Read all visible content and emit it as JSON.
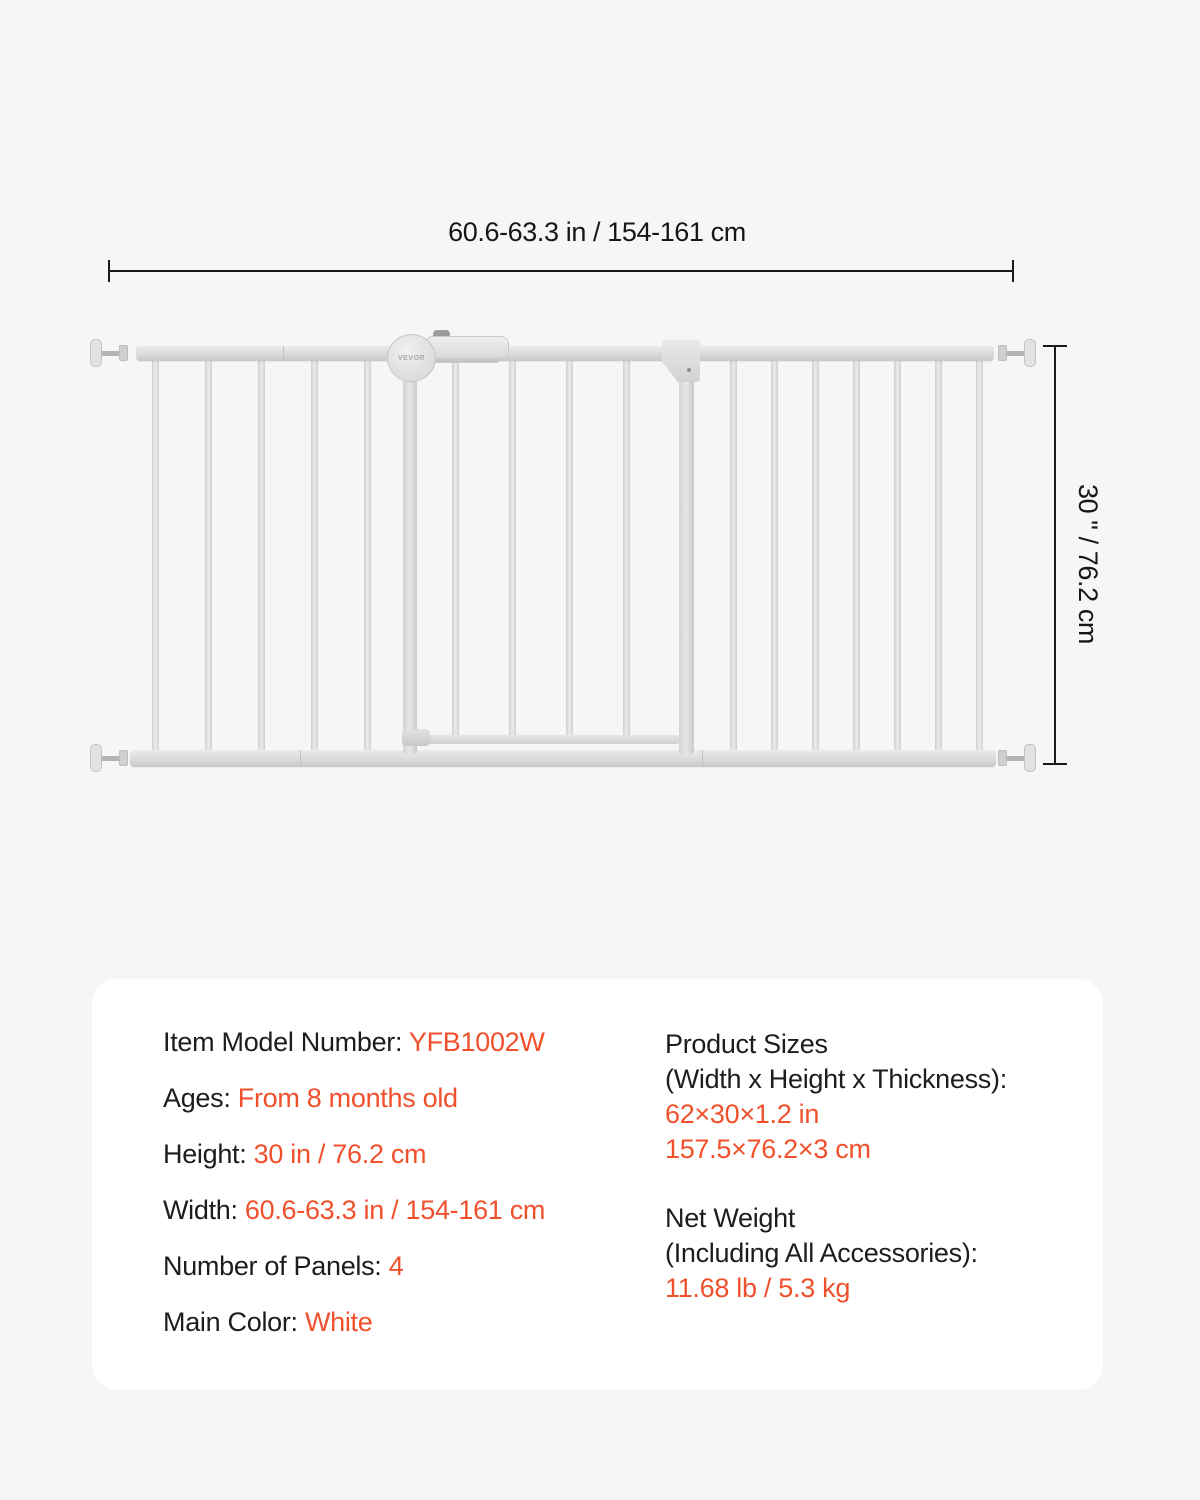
{
  "page": {
    "background_color": "#f6f6f5",
    "card_color": "#ffffff",
    "accent_color": "#f0512c"
  },
  "diagram": {
    "width_label": "60.6-63.3 in / 154-161 cm",
    "height_label": "30 \" / 76.2 cm",
    "brand_logo": "VEVOR"
  },
  "spec_card": {
    "left_column": [
      {
        "label": "Item Model Number: ",
        "value": "YFB1002W"
      },
      {
        "label": "Ages: ",
        "value": "From 8 months old"
      },
      {
        "label": "Height: ",
        "value": "30 in / 76.2 cm"
      },
      {
        "label": "Width: ",
        "value": "60.6-63.3 in / 154-161 cm"
      },
      {
        "label": "Number of Panels: ",
        "value": "4"
      },
      {
        "label": "Main Color: ",
        "value": "White"
      }
    ],
    "right_column": [
      {
        "lines": [
          {
            "text": "Product Sizes",
            "accent": false
          },
          {
            "text": "(Width x Height x Thickness):",
            "accent": false
          },
          {
            "text": "62×30×1.2 in",
            "accent": true
          },
          {
            "text": "157.5×76.2×3 cm",
            "accent": true
          }
        ]
      },
      {
        "lines": [
          {
            "text": "Net Weight",
            "accent": false
          },
          {
            "text": "(Including All Accessories):",
            "accent": false
          },
          {
            "text": "11.68 lb / 5.3 kg",
            "accent": true
          }
        ]
      }
    ]
  }
}
